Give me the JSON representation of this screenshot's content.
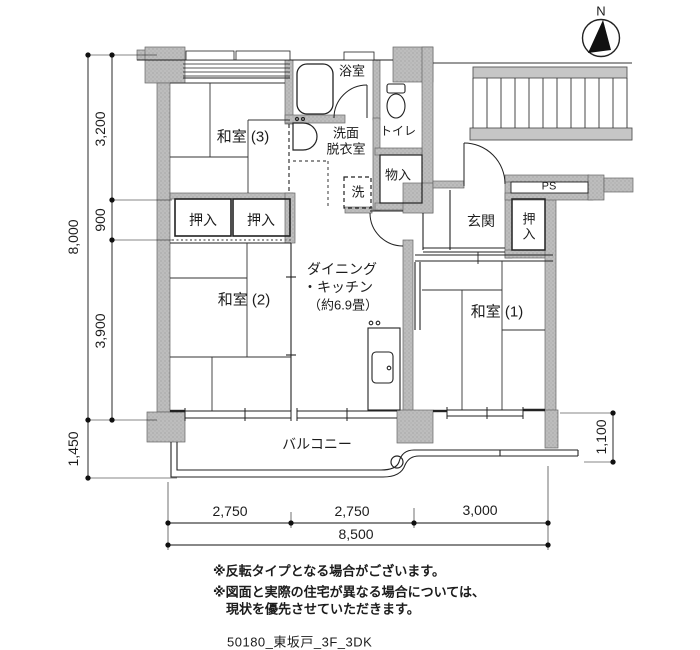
{
  "meta": {
    "type": "apartment-floor-plan"
  },
  "colors": {
    "wall_fill": "#bdbdbd",
    "wall_dot": "#9a9a9a",
    "line": "#1c1c1c",
    "stairs_fill": "#c6c6c6"
  },
  "compass": {
    "north_label": "N"
  },
  "rooms": {
    "washitsu3": "和室 (3)",
    "washitsu2": "和室 (2)",
    "washitsu1": "和室 (1)",
    "dk": [
      "ダイニング",
      "・キッチン",
      "（約6.9畳）"
    ],
    "bath": "浴室",
    "senmen": [
      "洗面",
      "脱衣室"
    ],
    "toilet": "トイレ",
    "storage": "物入",
    "genkan": "玄関",
    "closet_left": "押入",
    "closet_right": "押入",
    "closet_entry": "押入",
    "ps": "PS",
    "laundry": "洗",
    "balcony": "バルコニー"
  },
  "dims": {
    "left_total": "8,000",
    "left_segments": [
      "3,200",
      "900",
      "3,900"
    ],
    "balcony_left": "1,450",
    "balcony_right": "1,100",
    "bottom_segments": [
      "2,750",
      "2,750",
      "3,000"
    ],
    "bottom_total": "8,500"
  },
  "notes": {
    "line1": "※反転タイプとなる場合がございます。",
    "line2": "※図面と実際の住宅が異なる場合については、",
    "line3": "現状を優先させていただきます。"
  },
  "footer": {
    "plan_id": "50180_東坂戸_3F_3DK"
  }
}
